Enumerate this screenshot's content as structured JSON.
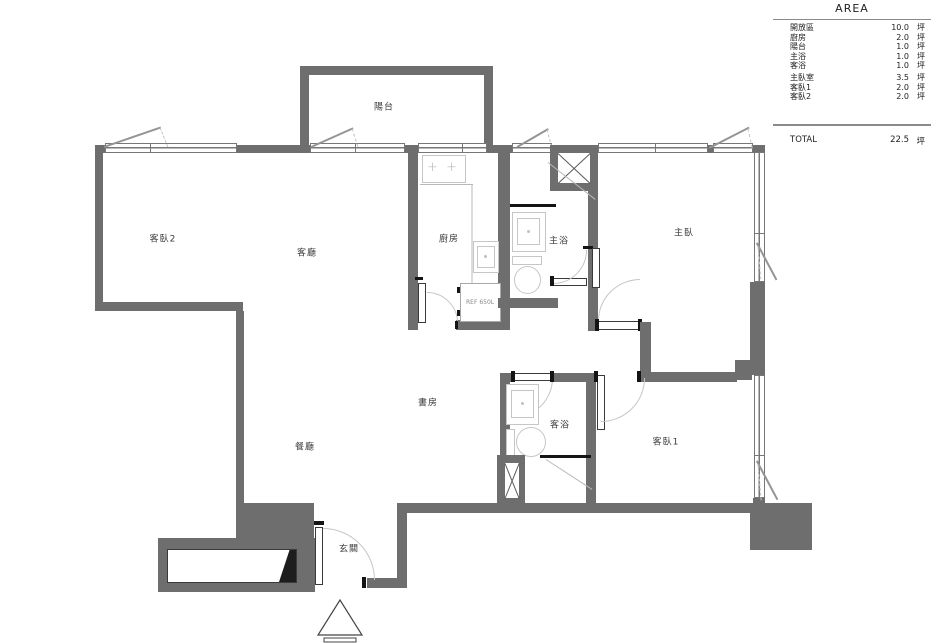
{
  "area_table": {
    "title": "AREA",
    "rows": [
      {
        "label": "開放區",
        "value": "10.0",
        "unit": "坪"
      },
      {
        "label": "廚房",
        "value": "2.0",
        "unit": "坪"
      },
      {
        "label": "陽台",
        "value": "1.0",
        "unit": "坪"
      },
      {
        "label": "主浴",
        "value": "1.0",
        "unit": "坪"
      },
      {
        "label": "客浴",
        "value": "1.0",
        "unit": "坪"
      },
      {
        "label": "主臥室",
        "value": "3.5",
        "unit": "坪"
      },
      {
        "label": "客臥1",
        "value": "2.0",
        "unit": "坪"
      },
      {
        "label": "客臥2",
        "value": "2.0",
        "unit": "坪"
      }
    ],
    "total": {
      "label": "TOTAL",
      "value": "22.5",
      "unit": "坪"
    }
  },
  "rooms": {
    "balcony": "陽台",
    "bedroom2": "客臥2",
    "living": "客廳",
    "kitchen": "廚房",
    "master_bath": "主浴",
    "master_bedroom": "主臥",
    "study": "書房",
    "dining": "餐廳",
    "guest_bath": "客浴",
    "bedroom1": "客臥1",
    "entry": "玄關"
  },
  "fixtures": {
    "ref_label": "REF 650L",
    "burner_glyph": "+"
  }
}
